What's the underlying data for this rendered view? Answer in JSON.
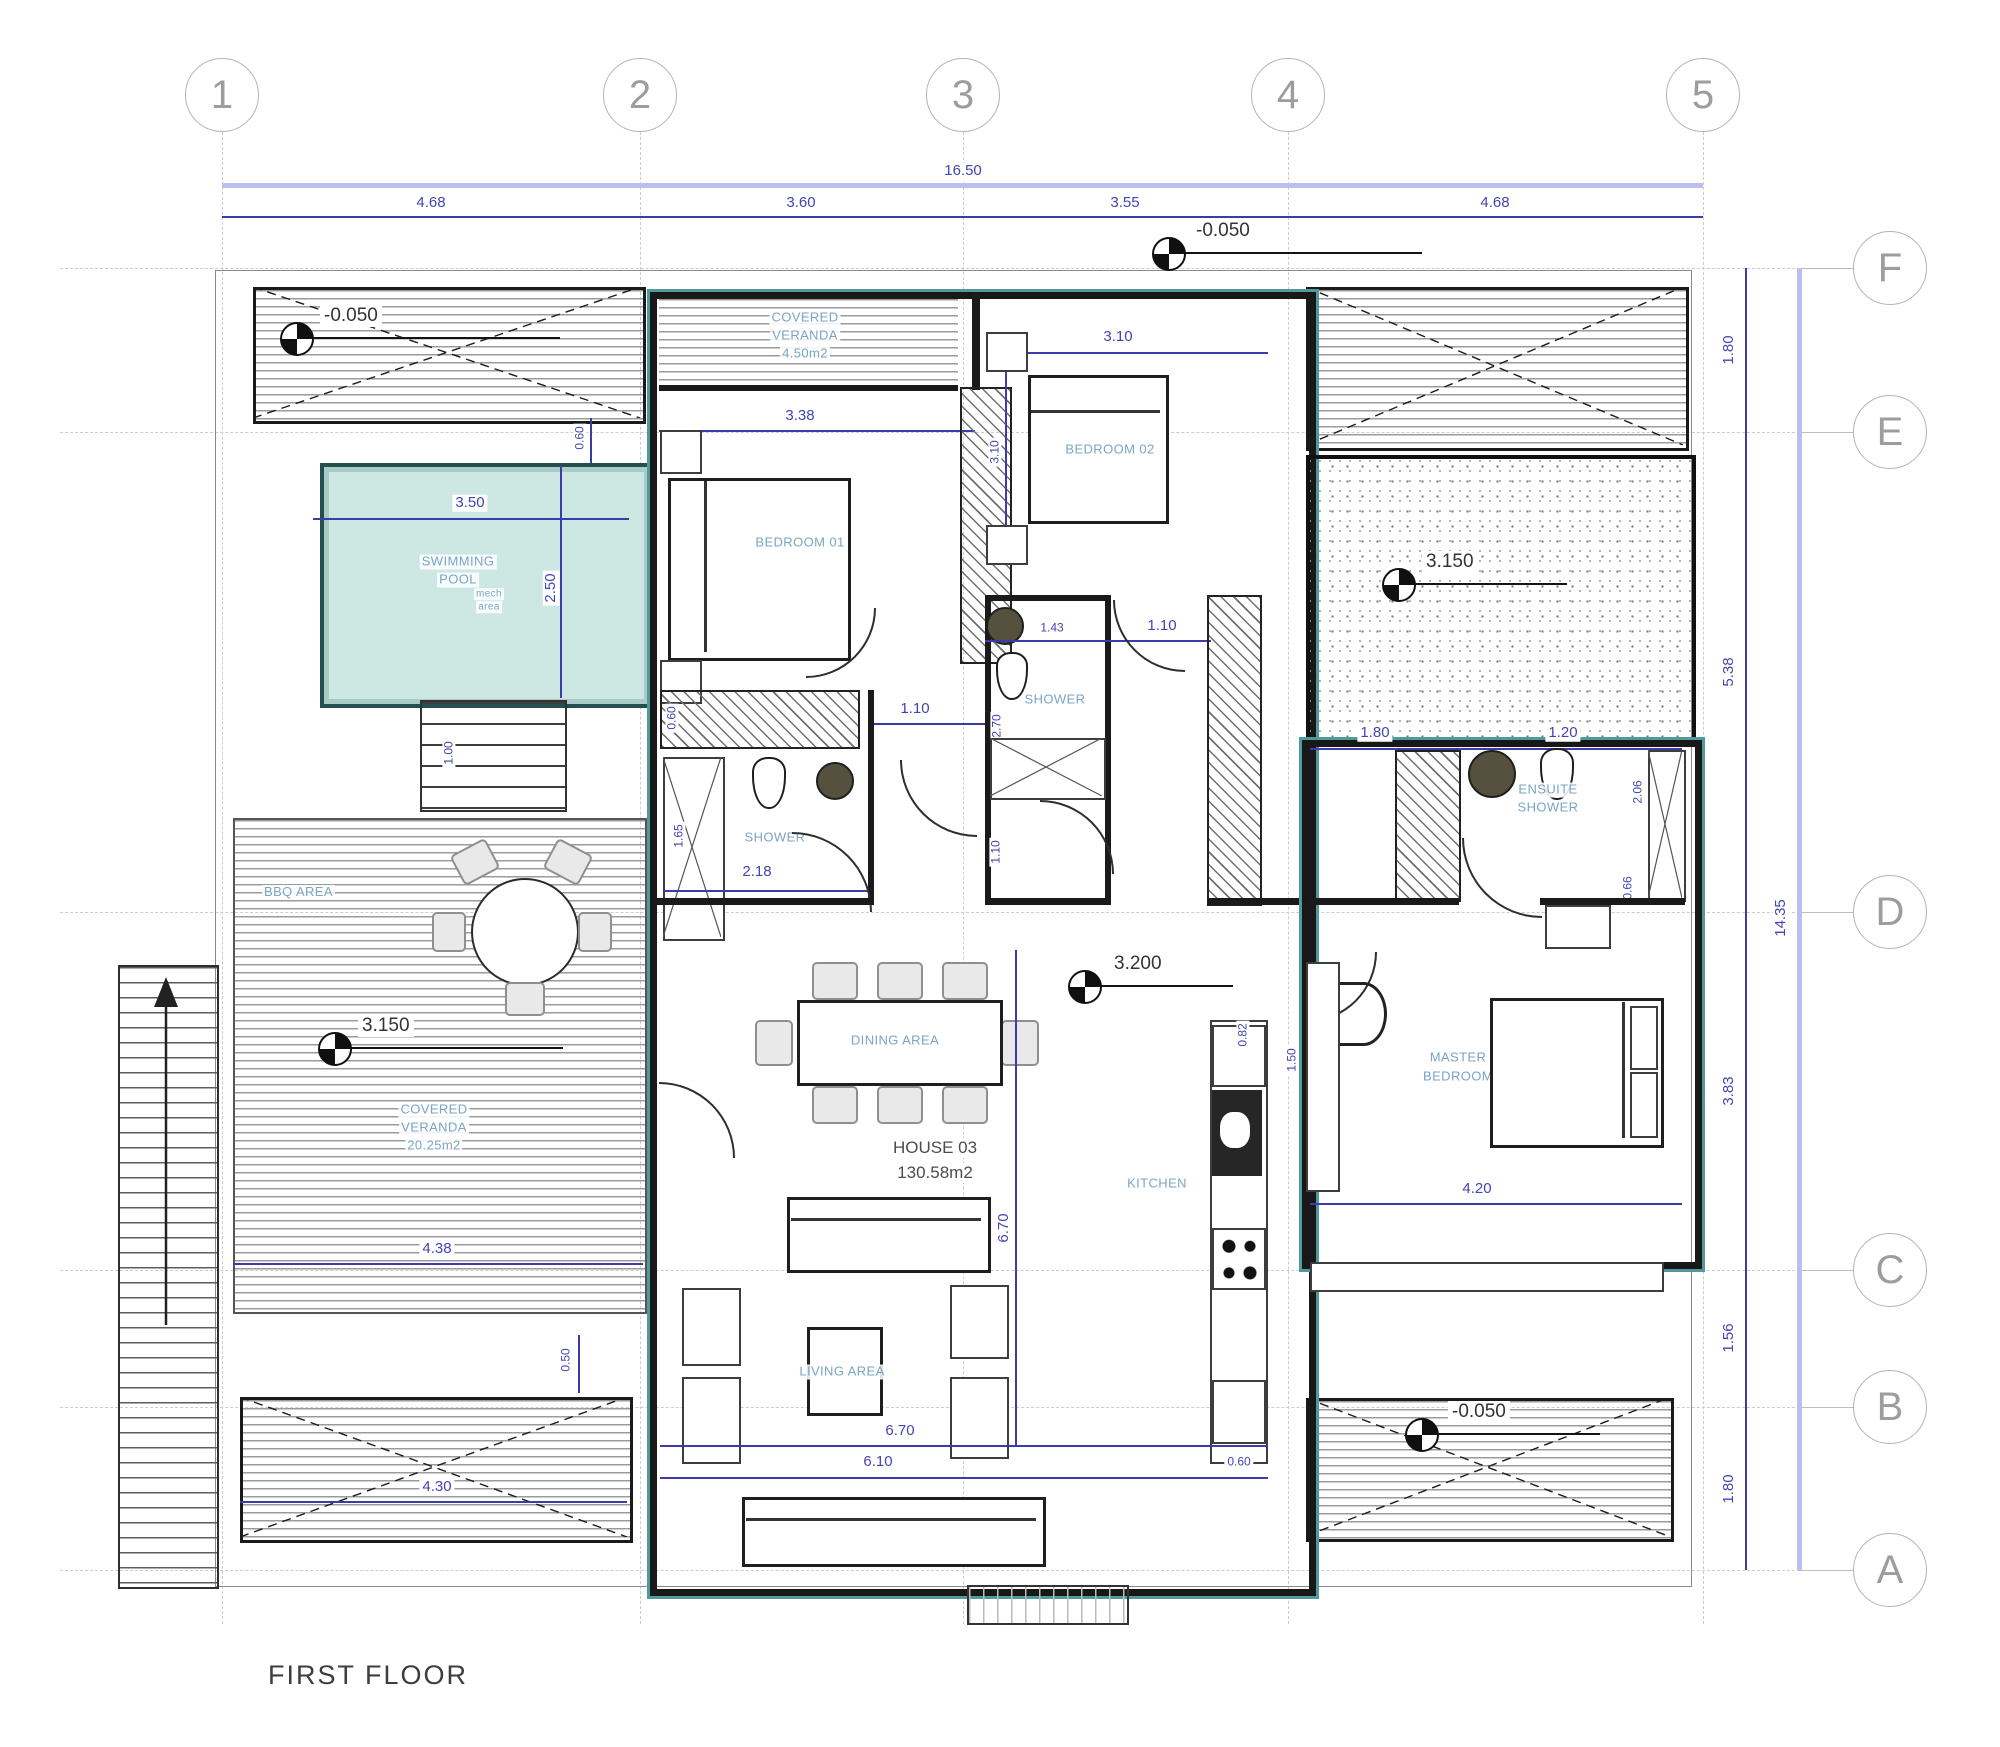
{
  "title": "FIRST FLOOR",
  "grid": {
    "cols": [
      "1",
      "2",
      "3",
      "4",
      "5"
    ],
    "col_dims": [
      "4.68",
      "3.60",
      "3.55",
      "4.68"
    ],
    "total_width": "16.50",
    "rows": [
      "F",
      "E",
      "D",
      "C",
      "B",
      "A"
    ],
    "row_dims": [
      "1.80",
      "5.38",
      "3.83",
      "1.56",
      "1.80"
    ],
    "total_height": "14.35"
  },
  "levels": {
    "top_left": "-0.050",
    "top_right": "-0.050",
    "gravel": "3.150",
    "veranda": "3.150",
    "interior": "3.200",
    "bottom_right": "-0.050"
  },
  "house": {
    "name": "HOUSE 03",
    "area": "130.58m2"
  },
  "rooms": {
    "swimming_pool": [
      "SWIMMING",
      "POOL"
    ],
    "veranda_top": [
      "COVERED",
      "VERANDA",
      "4.50m2"
    ],
    "veranda_left": [
      "COVERED",
      "VERANDA",
      "20.25m2"
    ],
    "bbq": "BBQ AREA",
    "mech": [
      "mech",
      "area"
    ],
    "bedroom01": "BEDROOM 01",
    "bedroom02": "BEDROOM 02",
    "shower_left": "SHOWER",
    "shower_mid": "SHOWER",
    "ensuite": [
      "ENSUITE",
      "SHOWER"
    ],
    "dining": "DINING AREA",
    "kitchen": "KITCHEN",
    "living": "LIVING AREA",
    "master": [
      "MASTER",
      "BEDROOM"
    ]
  },
  "dims": {
    "pool_width": "3.50",
    "pool_height": "2.50",
    "pool_offset": "0.60",
    "pool_steps": "1.00",
    "bedroom01_width": "3.38",
    "bedroom02_width": "3.10",
    "bedroom02_depth": "3.10",
    "shower_left_width": "2.18",
    "shower_left_depth": "1.65",
    "shower_left_offset": "0.60",
    "shower_mid_width": "1.43",
    "shower_mid_depth": "2.70",
    "hall_a": "1.10",
    "hall_b": "1.10",
    "hall_c": "1.10",
    "ensuite_a": "1.80",
    "ensuite_b": "1.20",
    "ensuite_depth": "2.06",
    "ensuite_c": "0.66",
    "master_width": "4.20",
    "interior_height": "6.70",
    "living_a": "6.70",
    "living_b": "6.10",
    "living_offset": "0.60",
    "kitchen_a": "0.82",
    "kitchen_b": "1.50",
    "terrace_a": "4.38",
    "terrace_b": "4.30",
    "terrace_offset": "0.50"
  }
}
